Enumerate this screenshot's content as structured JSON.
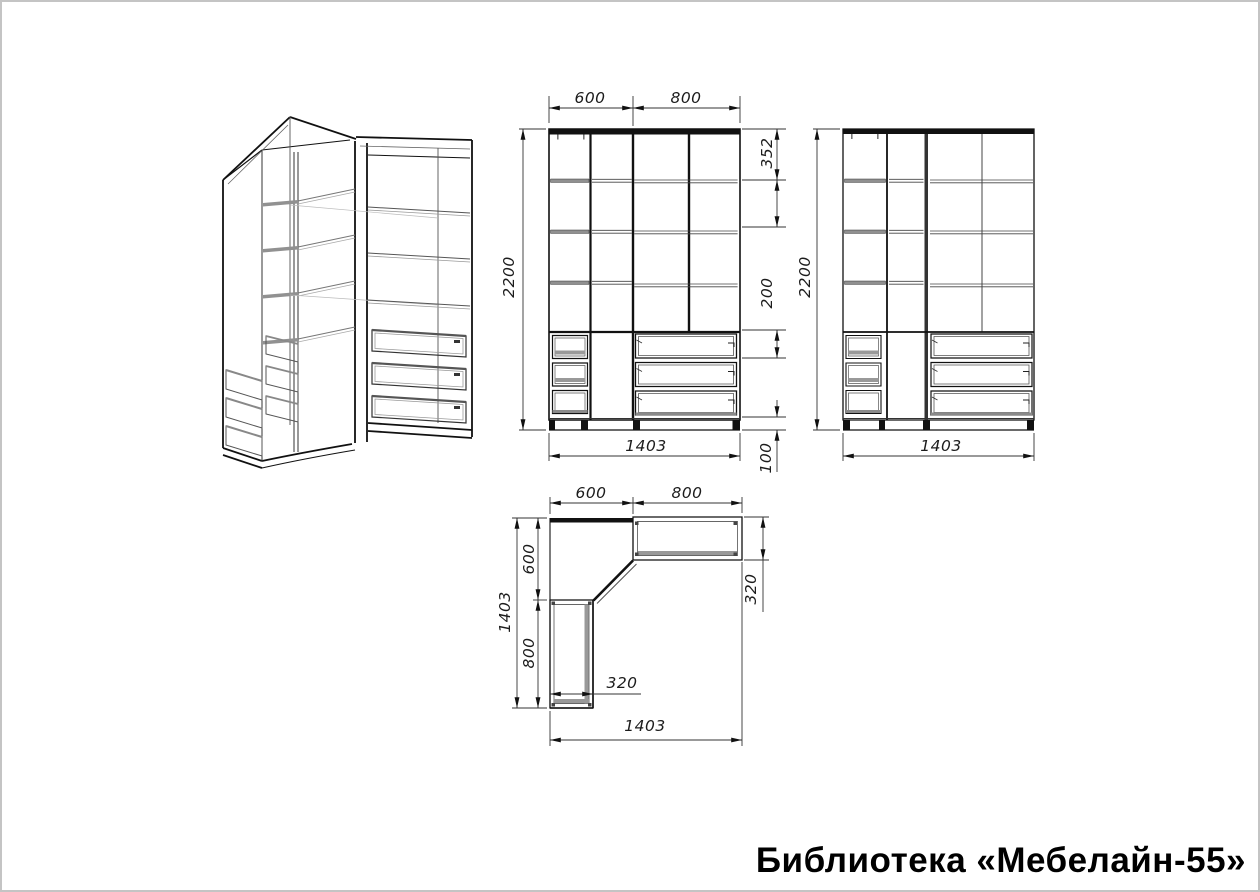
{
  "page": {
    "title": "Библиотека «Мебелайн-55»",
    "background_color": "#ffffff",
    "line_color": "#111111",
    "shelf_fill_color": "#909090",
    "frame_color": "#c4c4c4"
  },
  "views": {
    "front": {
      "width_left_mm": "600",
      "width_right_mm": "800",
      "height_mm": "2200",
      "top_shelf_mm": "352",
      "drawer_mm": "200",
      "plinth_mm": "100",
      "total_width_mm": "1403"
    },
    "back": {
      "height_mm": "2200",
      "total_width_mm": "1403"
    },
    "plan": {
      "width_left_mm": "600",
      "width_right_mm": "800",
      "depth_total_mm": "1403",
      "depth_upper_mm": "600",
      "depth_lower_mm": "800",
      "wing_depth_mm": "320",
      "wing_width_mm": "320",
      "total_width_mm": "1403"
    }
  }
}
